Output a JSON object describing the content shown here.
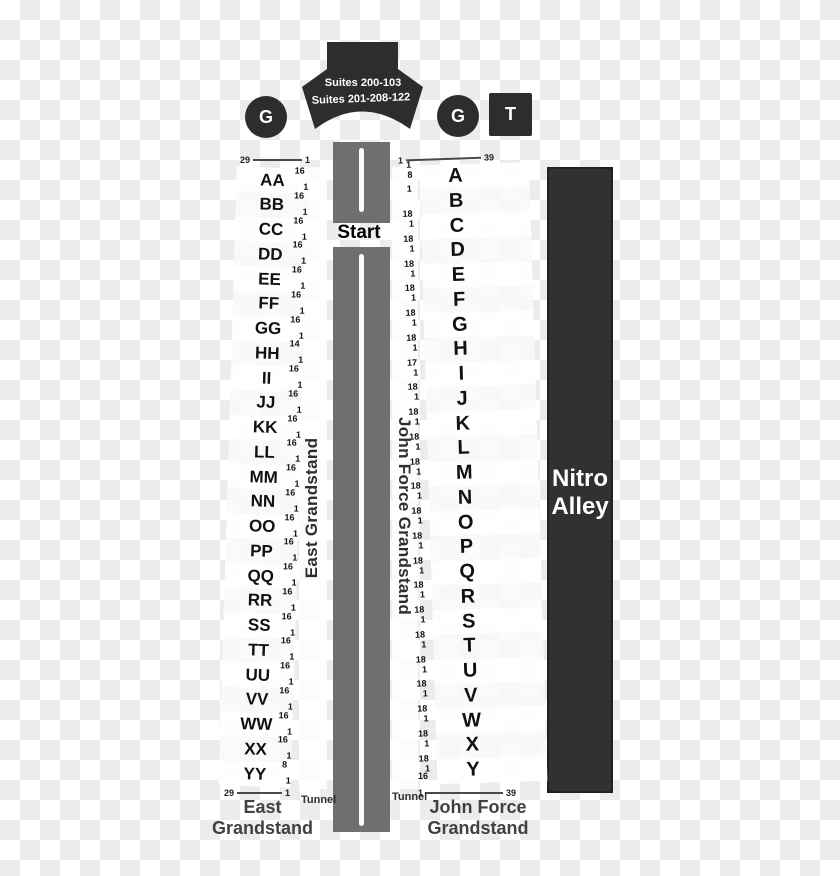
{
  "suites": {
    "line1": "Suites 200-103",
    "line2": "Suites 201-208-122"
  },
  "badges": {
    "gate_left": "G",
    "gate_right": "G",
    "tower": "T"
  },
  "track": {
    "start": "Start"
  },
  "nitro_alley": {
    "line1": "Nitro",
    "line2": "Alley"
  },
  "east": {
    "vertical_label": "East Grandstand",
    "bottom_label_line1": "East",
    "bottom_label_line2": "Grandstand",
    "tunnel": "Tunnel",
    "top_range": {
      "left": "29",
      "right": "1"
    },
    "bottom_range": {
      "left": "29",
      "right": "1"
    },
    "rows": [
      {
        "label": "AA",
        "upper": "16",
        "lower": "1"
      },
      {
        "label": "BB",
        "upper": "16",
        "lower": "1"
      },
      {
        "label": "CC",
        "upper": "16",
        "lower": "1"
      },
      {
        "label": "DD",
        "upper": "16",
        "lower": "1"
      },
      {
        "label": "EE",
        "upper": "16",
        "lower": "1"
      },
      {
        "label": "FF",
        "upper": "16",
        "lower": "1"
      },
      {
        "label": "GG",
        "upper": "16",
        "lower": "1"
      },
      {
        "label": "HH",
        "upper": "14",
        "lower": "1"
      },
      {
        "label": "II",
        "upper": "16",
        "lower": "1"
      },
      {
        "label": "JJ",
        "upper": "16",
        "lower": "1"
      },
      {
        "label": "KK",
        "upper": "16",
        "lower": "1"
      },
      {
        "label": "LL",
        "upper": "16",
        "lower": "1"
      },
      {
        "label": "MM",
        "upper": "16",
        "lower": "1"
      },
      {
        "label": "NN",
        "upper": "16",
        "lower": "1"
      },
      {
        "label": "OO",
        "upper": "16",
        "lower": "1"
      },
      {
        "label": "PP",
        "upper": "16",
        "lower": "1"
      },
      {
        "label": "QQ",
        "upper": "16",
        "lower": "1"
      },
      {
        "label": "RR",
        "upper": "16",
        "lower": "1"
      },
      {
        "label": "SS",
        "upper": "16",
        "lower": "1"
      },
      {
        "label": "TT",
        "upper": "16",
        "lower": "1"
      },
      {
        "label": "UU",
        "upper": "16",
        "lower": "1"
      },
      {
        "label": "VV",
        "upper": "16",
        "lower": "1"
      },
      {
        "label": "WW",
        "upper": "16",
        "lower": "1"
      },
      {
        "label": "XX",
        "upper": "16",
        "lower": "1"
      },
      {
        "label": "YY",
        "upper": "8",
        "lower": "1"
      }
    ]
  },
  "john_force": {
    "vertical_label": "John Force Grandstand",
    "bottom_label_line1": "John Force",
    "bottom_label_line2": "Grandstand",
    "tunnel": "Tunnel",
    "top_range": {
      "left": "1",
      "right": "39"
    },
    "bottom_range": {
      "left": "1",
      "right": "39"
    },
    "trailing_num": "16",
    "rows": [
      {
        "label": "A",
        "upper": "1",
        "lower": "8"
      },
      {
        "label": "B",
        "upper": "1",
        "lower": ""
      },
      {
        "label": "C",
        "upper": "18",
        "lower": "1"
      },
      {
        "label": "D",
        "upper": "18",
        "lower": "1"
      },
      {
        "label": "E",
        "upper": "18",
        "lower": "1"
      },
      {
        "label": "F",
        "upper": "18",
        "lower": "1"
      },
      {
        "label": "G",
        "upper": "18",
        "lower": "1"
      },
      {
        "label": "H",
        "upper": "18",
        "lower": "1"
      },
      {
        "label": "I",
        "upper": "17",
        "lower": "1"
      },
      {
        "label": "J",
        "upper": "18",
        "lower": "1"
      },
      {
        "label": "K",
        "upper": "18",
        "lower": "1"
      },
      {
        "label": "L",
        "upper": "18",
        "lower": "1"
      },
      {
        "label": "M",
        "upper": "18",
        "lower": "1"
      },
      {
        "label": "N",
        "upper": "18",
        "lower": "1"
      },
      {
        "label": "O",
        "upper": "18",
        "lower": "1"
      },
      {
        "label": "P",
        "upper": "18",
        "lower": "1"
      },
      {
        "label": "Q",
        "upper": "18",
        "lower": "1"
      },
      {
        "label": "R",
        "upper": "18",
        "lower": "1"
      },
      {
        "label": "S",
        "upper": "18",
        "lower": "1"
      },
      {
        "label": "T",
        "upper": "18",
        "lower": "1"
      },
      {
        "label": "U",
        "upper": "18",
        "lower": "1"
      },
      {
        "label": "V",
        "upper": "18",
        "lower": "1"
      },
      {
        "label": "W",
        "upper": "18",
        "lower": "1"
      },
      {
        "label": "X",
        "upper": "18",
        "lower": "1"
      },
      {
        "label": "Y",
        "upper": "18",
        "lower": "1"
      }
    ]
  },
  "colors": {
    "dark": "#2d2d2d",
    "track": "#6f6f6f",
    "nitro": "#313131",
    "checker": "#ececec"
  }
}
